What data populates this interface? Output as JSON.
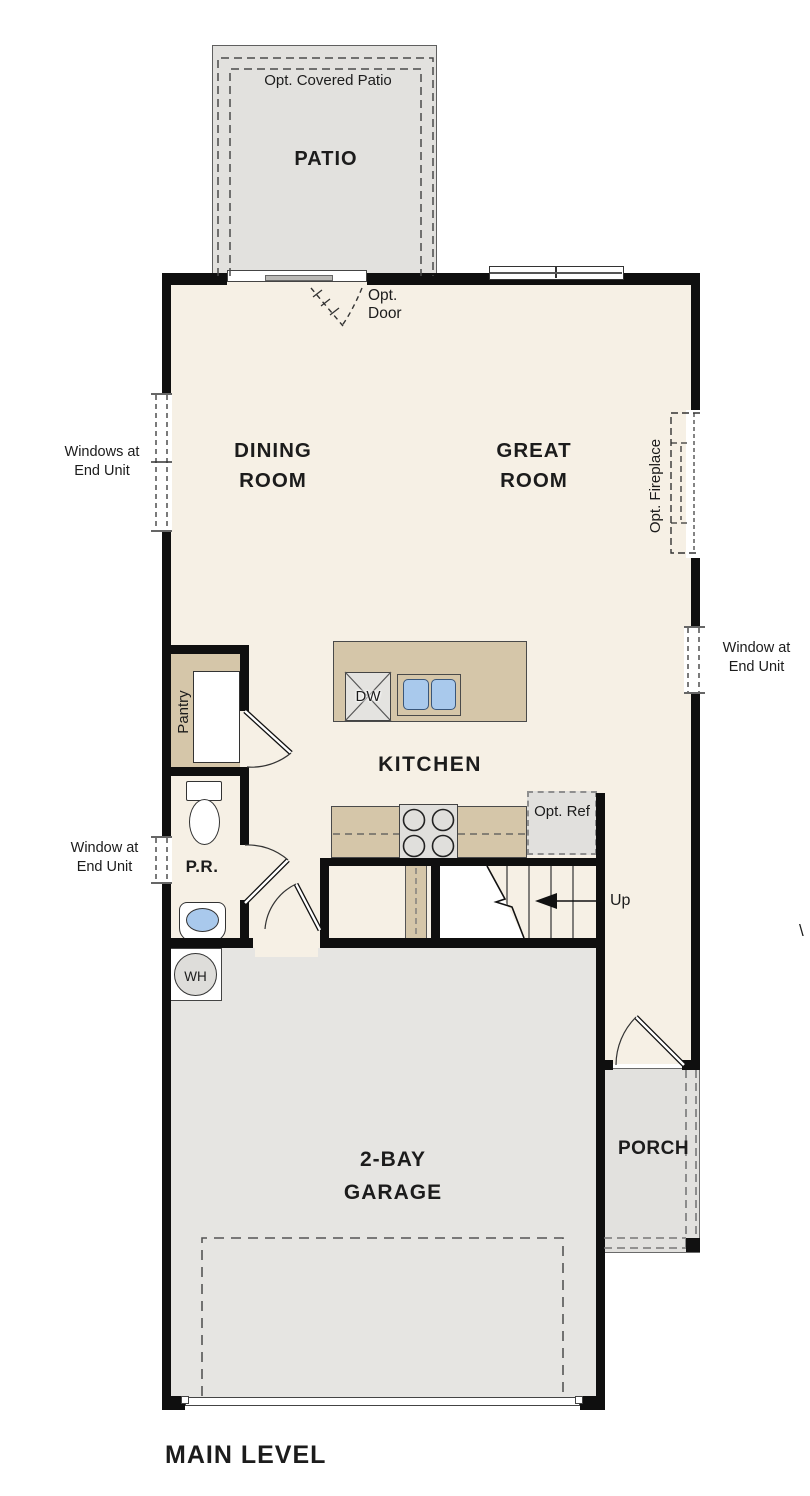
{
  "plan": {
    "title": "MAIN LEVEL",
    "rooms": {
      "patio": "PATIO",
      "dining_room": "DINING ROOM",
      "great_room": "GREAT ROOM",
      "kitchen": "KITCHEN",
      "pantry": "Pantry",
      "powder_room": "P.R.",
      "garage": "2-BAY GARAGE",
      "porch": "PORCH"
    },
    "annotations": {
      "opt_covered_patio": "Opt. Covered Patio",
      "opt_door": "Opt. Door",
      "windows_at_end_unit": "Windows at End Unit",
      "opt_fireplace": "Opt. Fireplace",
      "window_at_end_unit_left": "Window at End Unit",
      "window_at_end_unit_right": "Window at End Unit",
      "opt_ref": "Opt. Ref",
      "up": "Up",
      "dishwasher": "DW",
      "water_heater": "WH",
      "clipped_label_fragment": "\\"
    },
    "colors": {
      "floor_cream": "#f6f0e5",
      "outdoor_gray": "#e2e1de",
      "garage_gray": "#e6e5e2",
      "casework_tan": "#d5c6a9",
      "fixture_blue": "#a9c9ec",
      "wall_black": "#0f0f0f"
    }
  }
}
